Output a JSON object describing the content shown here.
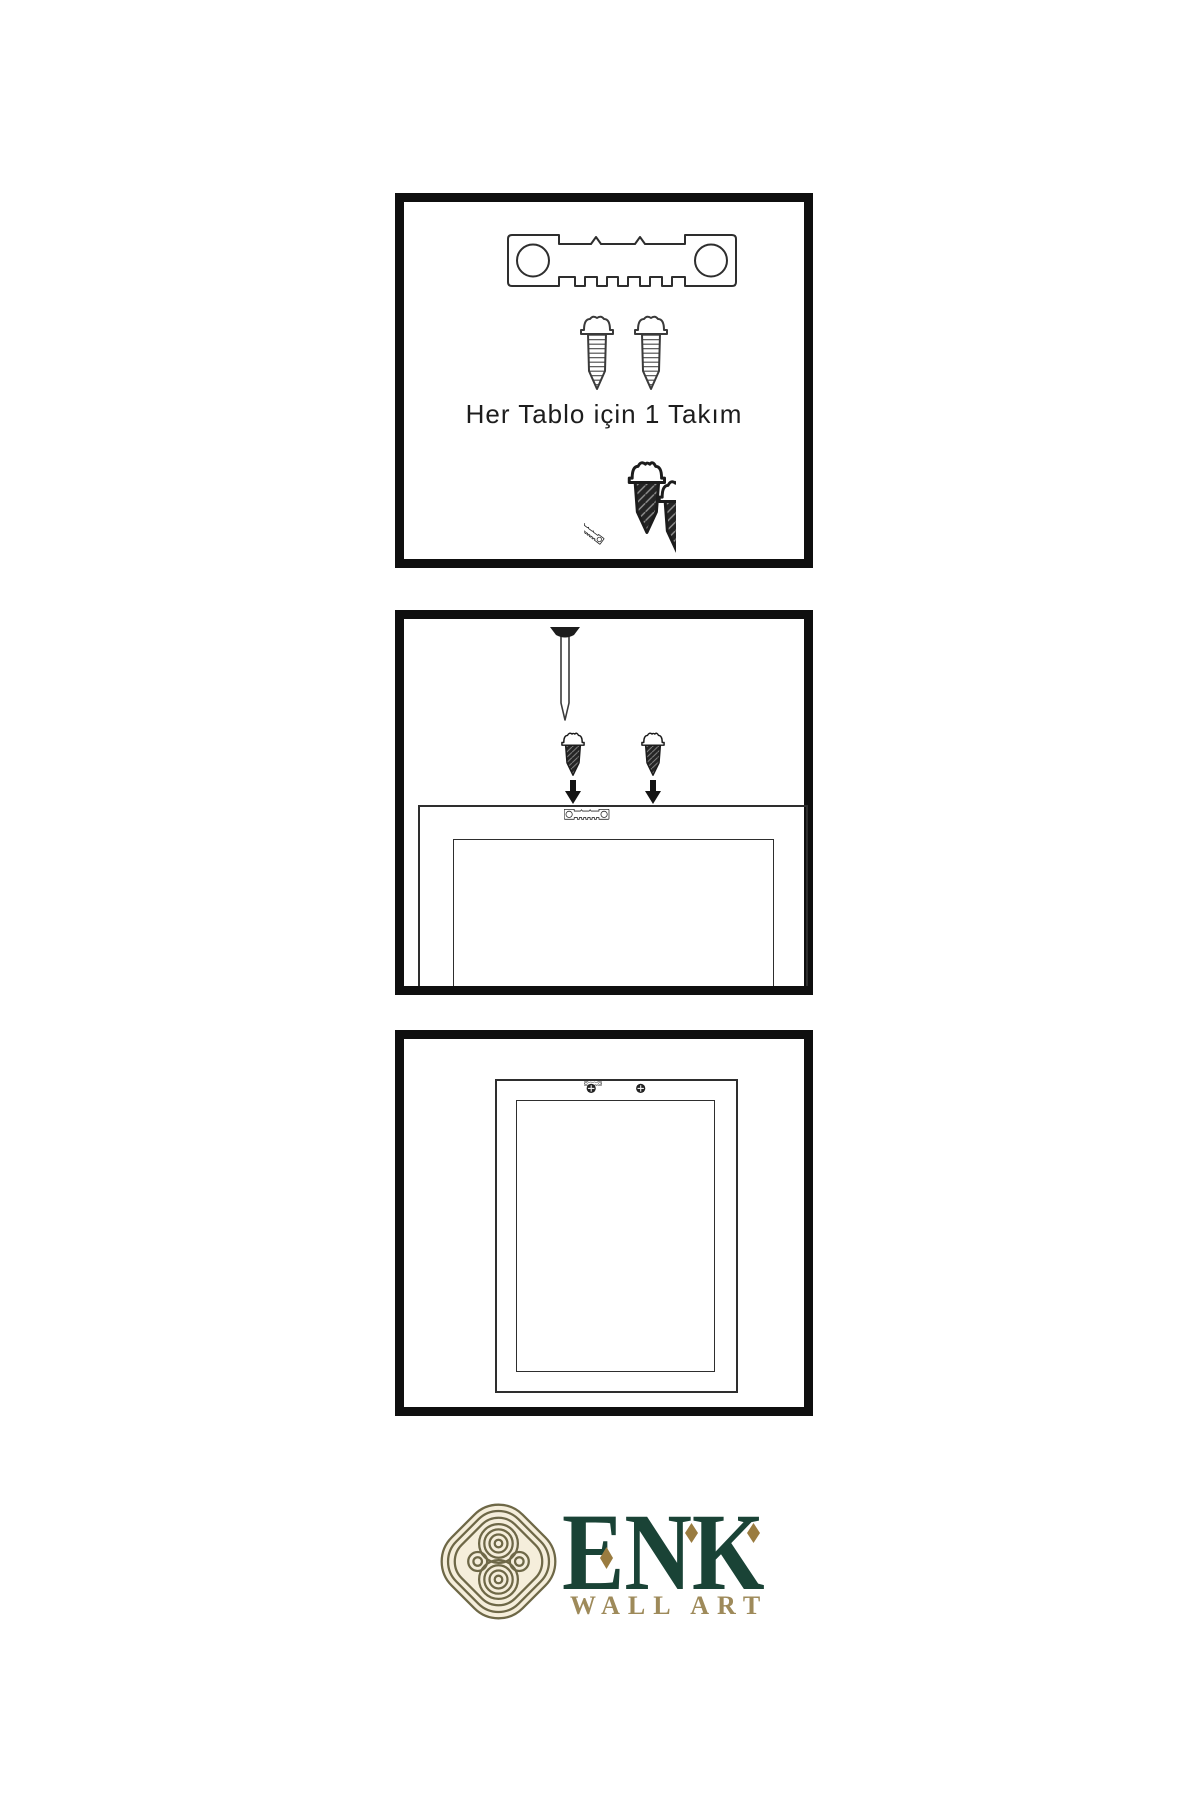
{
  "page": {
    "background": "#ffffff"
  },
  "steps": [
    {
      "name": "hardware-kit",
      "caption": "Her Tablo için 1 Takım",
      "parts": [
        "sawtooth-hanger",
        "screw",
        "screw",
        "screw-and-hanger-demo"
      ]
    },
    {
      "name": "attach-hanger-to-frame",
      "parts": [
        "wall-nail",
        "screw",
        "screw",
        "down-arrow",
        "down-arrow",
        "frame-back",
        "sawtooth-hanger"
      ]
    },
    {
      "name": "hanger-mounted-on-frame",
      "parts": [
        "frame-back",
        "mounted-sawtooth-hanger-with-screws"
      ]
    }
  ],
  "logo": {
    "brand": "ENK",
    "subtitle": "WALL ART",
    "emblem": "interlaced-knot-icon",
    "diamond_accents": 3
  },
  "colors": {
    "background": "#ffffff",
    "panel_border": "#0f0f0f",
    "line": "#2e2e2e",
    "dark_fill": "#1f1f1f",
    "text": "#1d1d1d",
    "logo_green": "#1a4336",
    "logo_gold": "#9a7c40",
    "logo_tan": "#9e8a5a",
    "knot_line": "#6e6847",
    "knot_bg": "#f5eedb"
  }
}
